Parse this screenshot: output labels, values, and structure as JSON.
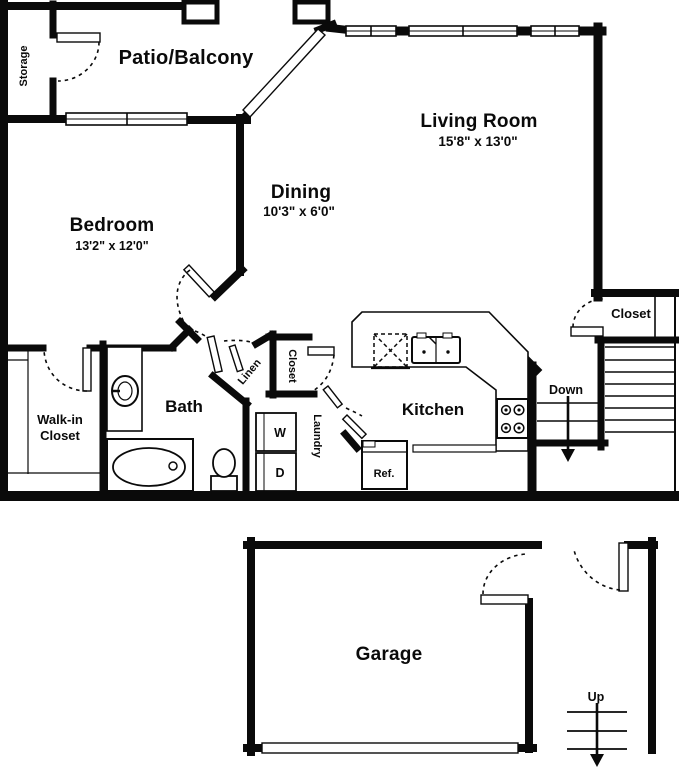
{
  "colors": {
    "wall": "#0a0a0a",
    "background": "#ffffff"
  },
  "rooms": {
    "patio": {
      "name": "Patio/Balcony"
    },
    "storage": {
      "name": "Storage"
    },
    "living": {
      "name": "Living Room",
      "dims": "15'8\" x 13'0\""
    },
    "dining": {
      "name": "Dining",
      "dims": "10'3\" x 6'0\""
    },
    "bedroom": {
      "name": "Bedroom",
      "dims": "13'2\" x 12'0\""
    },
    "walkin": {
      "line1": "Walk-in",
      "line2": "Closet"
    },
    "bath": {
      "name": "Bath"
    },
    "linen": {
      "name": "Linen"
    },
    "hall_closet": {
      "name": "Closet"
    },
    "laundry": {
      "name": "Laundry",
      "washer": "W",
      "dryer": "D"
    },
    "kitchen": {
      "name": "Kitchen",
      "fridge": "Ref."
    },
    "stair_closet": {
      "name": "Closet"
    },
    "stairs_down": {
      "label": "Down"
    },
    "garage": {
      "name": "Garage"
    },
    "stairs_up": {
      "label": "Up"
    }
  }
}
